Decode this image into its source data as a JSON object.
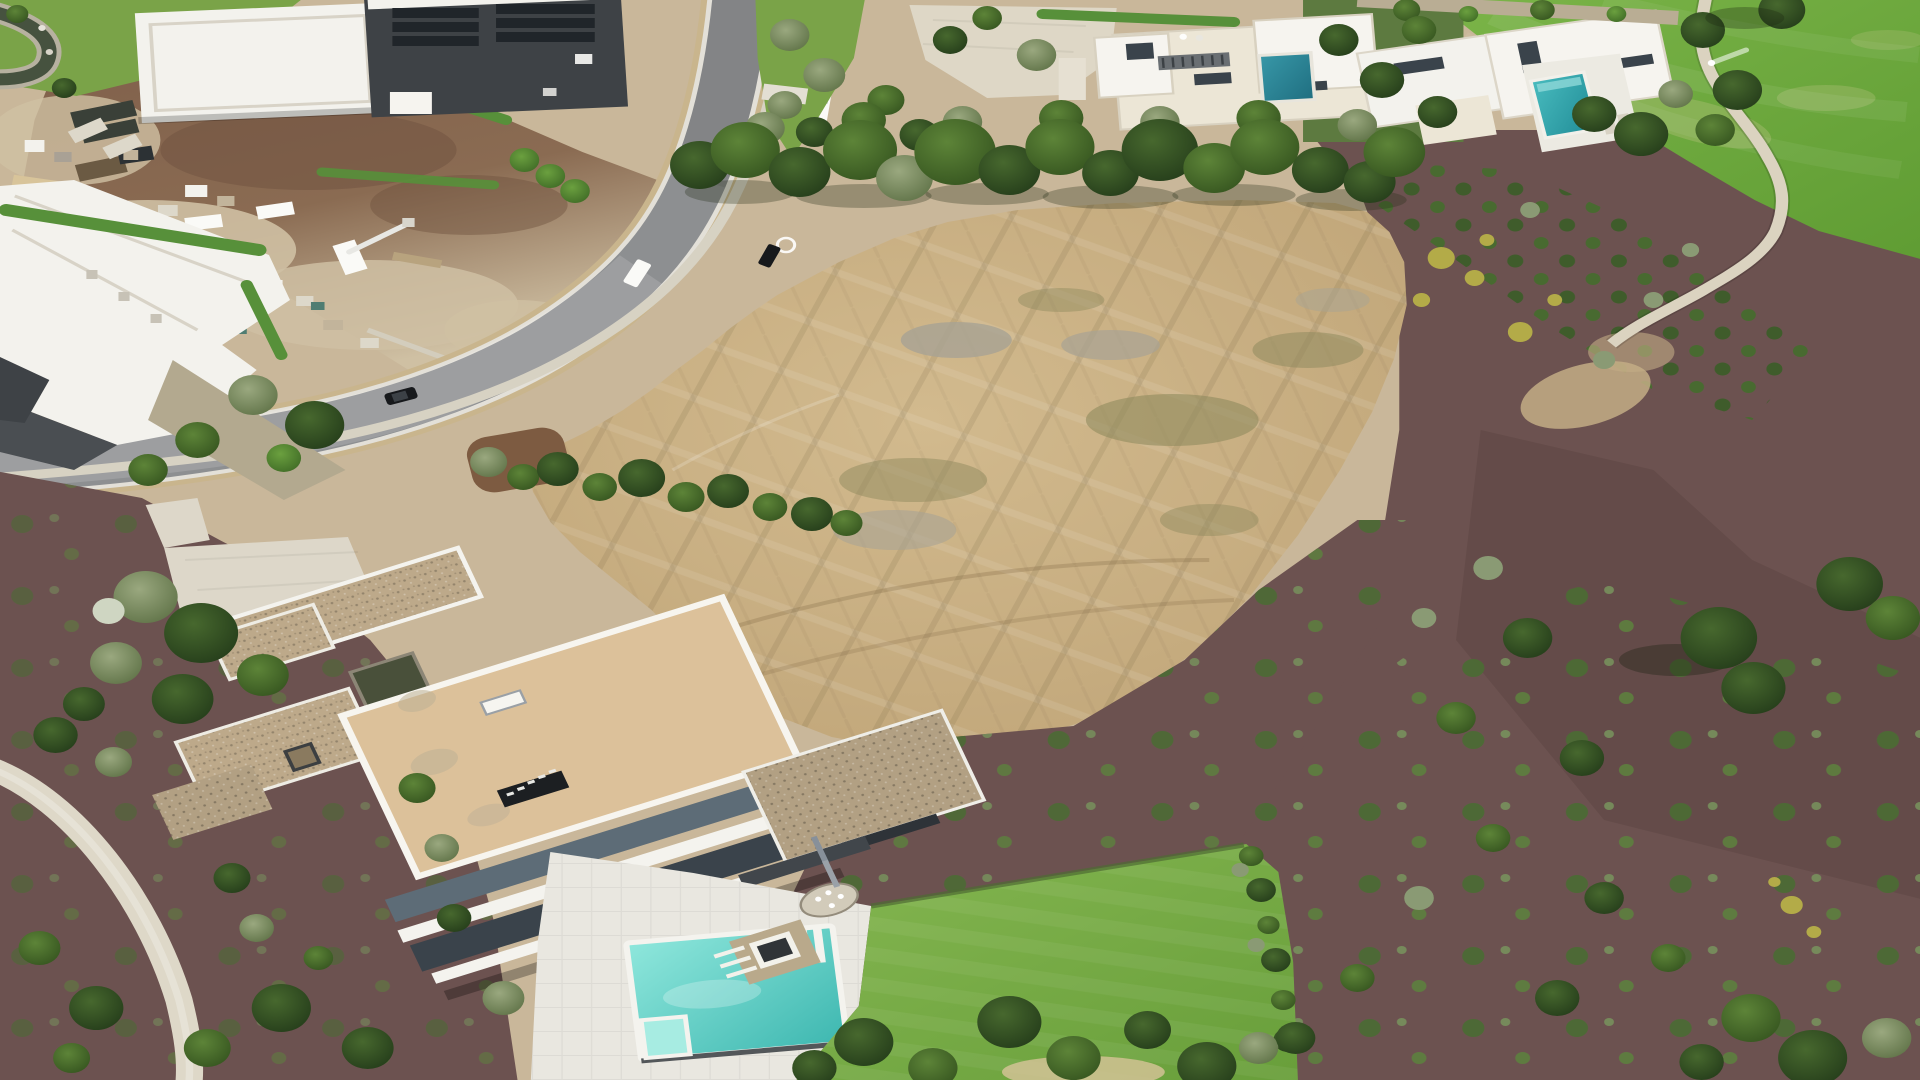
{
  "meta": {
    "title": "Aerial drone photograph",
    "description": "Overhead aerial photo of a luxury desert residential community: a large graded tan vacant lot in the center with tire tracks, a modern flat-roof mansion with turquoise pool and lawn at lower left, a construction staging yard with trucks and materials at upper left, a curving gray road with vehicles, cream modern houses with pools along the top, and a green golf course with winding cart path and dark reddish mulch landscaping down the right side.",
    "width": 1920,
    "height": 1080
  },
  "palette": {
    "base_ground": "#c9b79a",
    "dirt_lot": "#c9b083",
    "dirt_light": "#d8c49a",
    "dirt_gray": "#a8a394",
    "dirt_olive": "#8f8a5e",
    "dirt_mound": "#7d5b41",
    "site_brown": "#80604b",
    "site_sand": "#cfc0a3",
    "road_asphalt": "#8d8f91",
    "shoulder": "#c9b58d",
    "curb": "#e3e0d8",
    "sidewalk": "#d7d2c3",
    "cart_path": "#dbd3c0",
    "garden_walk": "#ded8c8",
    "motor_court": "#ddd7c9",
    "driveway": "#ded7c6",
    "deck": "#e9e7e0",
    "mulch": "#6c5250",
    "mulch_dark": "#57423f",
    "fairway_green": "#7cb549",
    "fairway_deep": "#5f9c33",
    "fairway_worn": "#a9bd72",
    "lawn_green": "#85b751",
    "verge": "#7aa348",
    "garden_base": "#5d7a40",
    "hedge": "#57903a",
    "tree_dark": "#243c1a",
    "tree_mid": "#35541f",
    "shrub_sage": "#8a9a74",
    "shrub_yellow": "#b3ab48",
    "shrub_bloom": "#cfd6c2",
    "roof_white": "#f3f2ed",
    "roof_cream": "#ece6d6",
    "roof_cream2": "#f6f4ef",
    "roof_charcoal": "#3e4246",
    "roof_gray": "#4a4e52",
    "parapet": "#d8d1c0",
    "solar_panel": "#20252a",
    "mansion_tan": "#dcc19a",
    "mansion_pebble": "#bda98a",
    "mansion_pebble2": "#b2a083",
    "fascia_white": "#f4f3ee",
    "fascia_blue": "#5d6c77",
    "glass_dark": "#3a434b",
    "sign_dark": "#1c1f22",
    "pool_light": "#8fe7dc",
    "pool_deep": "#3db7b0",
    "spa": "#a7ece2",
    "pool_teal_a": "#1f6e80",
    "pool_teal_b": "#1f8a95",
    "pond": "#49503a",
    "creek": "#46523f",
    "stone_table": "#d2cbba",
    "vehicle_white": "#fafaf7",
    "vehicle_dark": "#2c3134",
    "vehicle_black": "#17191c",
    "vehicle_red": "#b23527",
    "container_dark": "#3a4038",
    "container_brown": "#6b5a43",
    "bin_teal": "#4f7d72",
    "wall_light": "#d3cdbd"
  },
  "scene": {
    "regions": [
      {
        "id": "vacant-lot",
        "label": "graded tan vacant lot with tire tracks"
      },
      {
        "id": "construction-yard",
        "label": "construction staging yard with equipment and materials"
      },
      {
        "id": "curving-road",
        "label": "curved asphalt street with sidewalk"
      },
      {
        "id": "golf-course",
        "label": "golf course fairway with cart path"
      },
      {
        "id": "mulch-landscaping",
        "label": "reddish mulch slope planted with shrub rows"
      },
      {
        "id": "modern-mansion",
        "label": "flat-roof modern mansion with pool deck and lawn"
      },
      {
        "id": "upper-houses",
        "label": "cream modern houses with pools"
      },
      {
        "id": "upper-left-estate",
        "label": "white estate with dark solar roof"
      },
      {
        "id": "left-building",
        "label": "white stepped-roof building with hedges"
      }
    ],
    "water_features": [
      "main-swimming-pool",
      "spa",
      "house-a-pool",
      "house-b-pool",
      "garden-pond",
      "creek"
    ],
    "vehicles": [
      "white-van",
      "landscape-truck",
      "white-pickup",
      "parked-car",
      "black-suv",
      "construction-van",
      "box-trailer",
      "red-truck",
      "boom-lift",
      "cube-trailer",
      "dump-truck"
    ],
    "counts": {
      "pools": 3,
      "roads": 1,
      "cart_paths": 1,
      "houses": 5
    }
  }
}
